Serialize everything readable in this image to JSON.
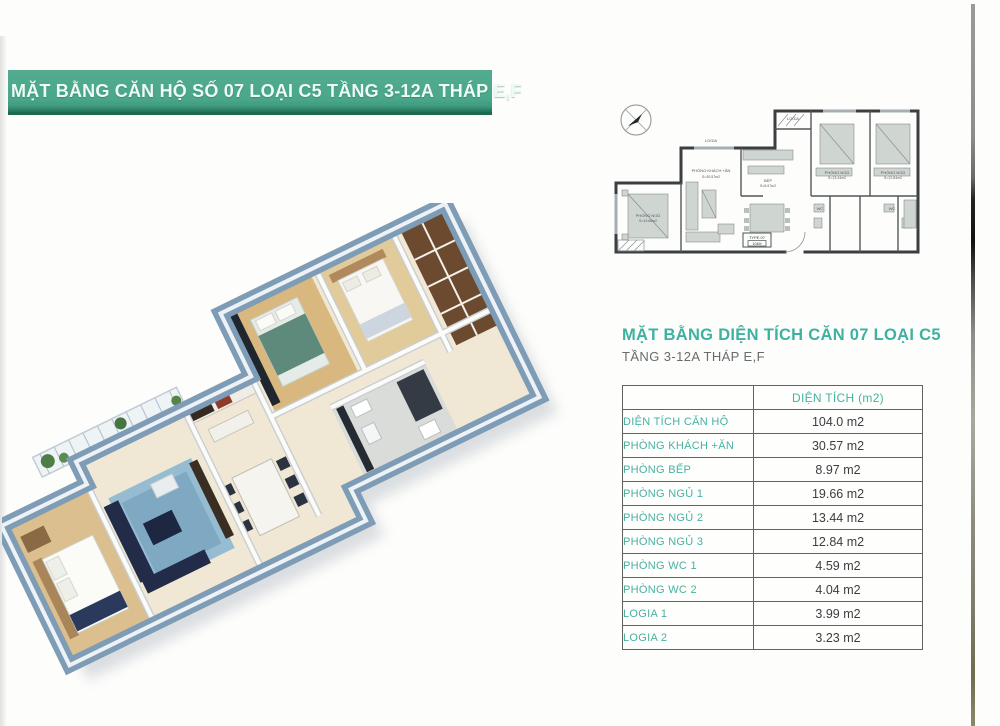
{
  "banner": {
    "text": "MẶT BẰNG CĂN HỘ SỐ 07 LOẠI C5 TẦNG 3-12A THÁP E,F",
    "bg_color": "#4aa78b",
    "text_color": "#eefaf4"
  },
  "section": {
    "title": "MẶT BẰNG DIỆN TÍCH CĂN 07 LOẠI C5",
    "subtitle": "TẦNG 3-12A THÁP E,F",
    "title_color": "#3db2a0"
  },
  "table": {
    "header_col1": "",
    "header_col2": "DIỆN TÍCH (m2)",
    "rows": [
      {
        "label": "DIỆN TÍCH CĂN HỘ",
        "value": "104.0 m2"
      },
      {
        "label": "PHÒNG KHÁCH +ĂN",
        "value": "30.57 m2"
      },
      {
        "label": "PHÒNG BẾP",
        "value": "8.97 m2"
      },
      {
        "label": "PHÒNG NGỦ 1",
        "value": "19.66 m2"
      },
      {
        "label": "PHÒNG NGỦ 2",
        "value": "13.44 m2"
      },
      {
        "label": "PHÒNG NGỦ 3",
        "value": "12.84 m2"
      },
      {
        "label": "PHÒNG WC 1",
        "value": "4.59 m2"
      },
      {
        "label": "PHÒNG WC 2",
        "value": "4.04 m2"
      },
      {
        "label": "LOGIA 1",
        "value": "3.99 m2"
      },
      {
        "label": "LOGIA 2",
        "value": "3.23 m2"
      }
    ]
  },
  "plan2d": {
    "labels": {
      "logia": "LOGIA",
      "living": "PHÒNG KHÁCH +ĂN",
      "kitchen": "BẾP",
      "bedroom": "PHÒNG NGỦ",
      "wc": "WC",
      "type_line1": "TYPE 07",
      "type_line2": "104M"
    },
    "areas": {
      "ngu1": "S=19.66m2",
      "khach": "S=30.57m2",
      "bep": "S=8.97m2",
      "ngu2": "S=13.44m2",
      "ngu3": "S=12.84m2",
      "logia": "S=3.99m2"
    }
  },
  "colors": {
    "wall_3d": "#7e9cb6",
    "floor_cream": "#f0e8d4",
    "floor_wood": "#dcbf8e",
    "rug_blue": "#96bcd2",
    "sofa_navy": "#222c49",
    "plan_line": "#3b3f42",
    "table_border": "#5f6365",
    "teal": "#45b2a2"
  }
}
